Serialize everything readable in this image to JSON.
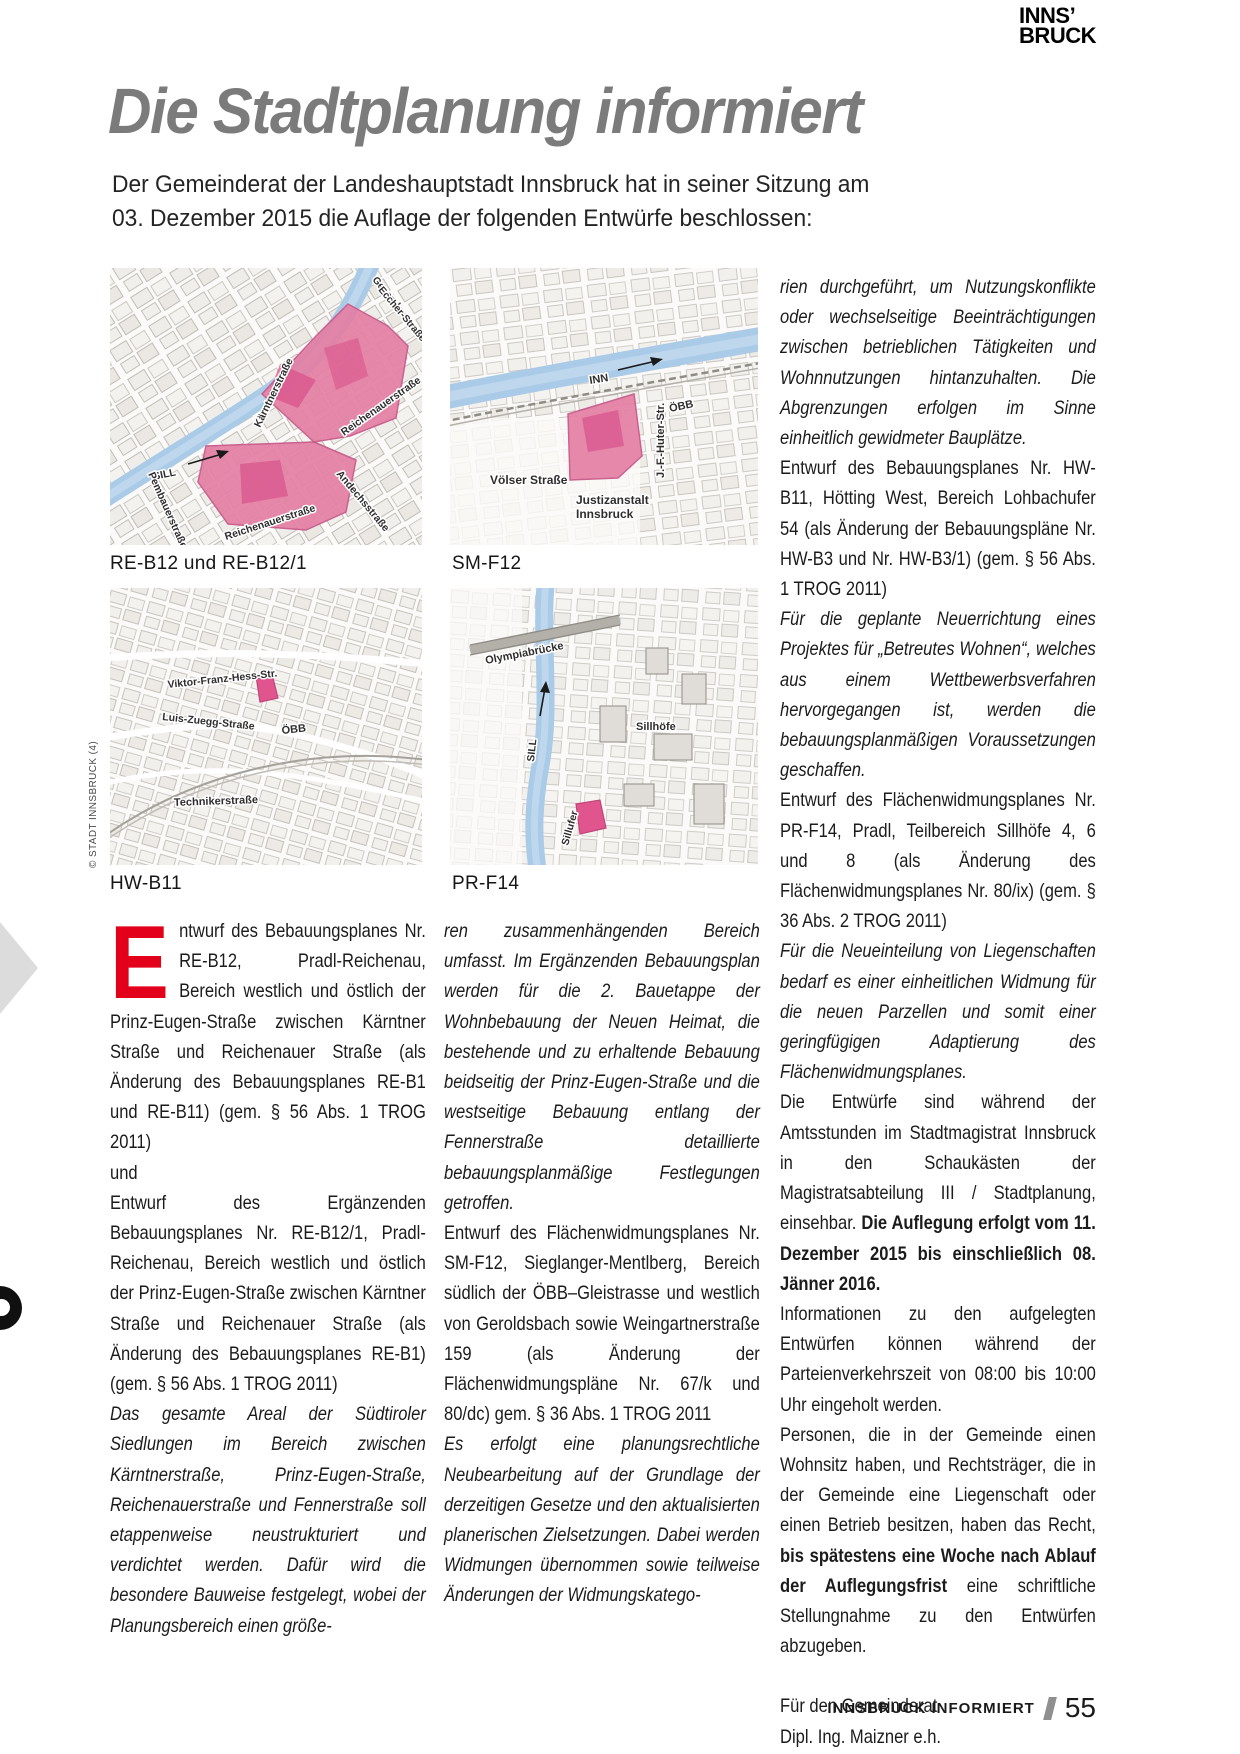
{
  "page": {
    "logo_line1": "INNS’",
    "logo_line2": "BRUCK",
    "title": "Die Stadtplanung informiert",
    "intro_line1": "Der Gemeinderat der Landeshauptstadt Innsbruck hat in seiner Sitzung am",
    "intro_line2": "03. Dezember 2015 die Auflage der folgenden Entwürfe beschlossen:",
    "credit": "© STADT INNSBRUCK (4)"
  },
  "colors": {
    "accent_red": "#e2001a",
    "highlight_pink": "#e47fa4",
    "river_blue": "#a9cbe7",
    "title_gray": "#7b7b7b",
    "footer_slash_gray": "#8f8f8f"
  },
  "maps": [
    {
      "id": "RE-B12",
      "caption": "RE-B12 und RE-B12/1",
      "labels": {
        "general_1": "General-",
        "general_2": "Eccher-Straße",
        "kaerntner": "Kärntnerstraße",
        "reichenauer_right": "Reichenauerstraße",
        "sill": "SILL",
        "pembauer": "Pembauerstraße",
        "reichenauer_bottom": "Reichenauerstraße",
        "andechs": "Andechsstraße"
      }
    },
    {
      "id": "SM-F12",
      "caption": "SM-F12",
      "labels": {
        "inn": "INN",
        "oebb": "ÖBB",
        "voelser": "Völser Straße",
        "huter": "J.-F.-Huter-Str.",
        "justiz_1": "Justizanstalt",
        "justiz_2": "Innsbruck"
      }
    },
    {
      "id": "HW-B11",
      "caption": "HW-B11",
      "labels": {
        "viktor": "Viktor-Franz-Hess-Str.",
        "luis": "Luis-Zuegg-Straße",
        "oebb": "ÖBB",
        "techniker": "Technikerstraße"
      }
    },
    {
      "id": "PR-F14",
      "caption": "PR-F14",
      "labels": {
        "olympiabruecke": "Olympiabrücke",
        "sill": "SILL",
        "sillhoefe": "Sillhöfe",
        "sillufer": "Sillufer"
      }
    }
  ],
  "columns": {
    "col1": {
      "paragraphs": [
        {
          "runs": [
            {
              "t": "E",
              "drop": true
            },
            {
              "t": "ntwurf des Bebauungsplanes Nr. RE-B12, Pradl-Reichenau, Bereich westlich und östlich der Prinz-Eugen-Straße zwischen Kärntner Straße und Reichenauer Straße (als Änderung des Bebauungsplanes RE-B1 und RE-B11) (gem. § 56 Abs. 1 TROG 2011)"
            }
          ]
        },
        {
          "runs": [
            {
              "t": "und"
            }
          ]
        },
        {
          "runs": [
            {
              "t": "Entwurf des Ergänzenden Bebauungsplanes Nr. RE-B12/1, Pradl-Reichenau, Bereich westlich und östlich der Prinz-Eugen-Straße zwischen Kärntner Straße und Reichenauer Straße (als Änderung des Bebauungsplanes RE-B1) (gem. § 56 Abs. 1 TROG 2011)"
            }
          ]
        },
        {
          "runs": [
            {
              "t": "Das gesamte Areal der Südtiroler Siedlungen im Bereich zwischen Kärntnerstraße, Prinz-Eugen-Straße, Reichenauerstraße und Fennerstraße soll etappenweise neustrukturiert und verdichtet werden. Dafür wird die besondere Bauweise festgelegt, wobei der Planungsbereich einen größe-",
              "i": true
            }
          ]
        }
      ]
    },
    "col2": {
      "paragraphs": [
        {
          "runs": [
            {
              "t": "ren zusammenhängenden Bereich umfasst. Im Ergänzenden Bebauungsplan werden für die 2. Bauetappe der Wohnbebauung der Neuen Heimat, die bestehende und zu erhaltende Bebauung beidseitig der Prinz-Eugen-Straße und die westseitige Bebauung entlang der Fennerstraße detaillierte bebauungsplanmäßige Festlegungen getroffen.",
              "i": true
            }
          ]
        },
        {
          "runs": [
            {
              "t": "Entwurf des Flächenwidmungsplanes Nr. SM-F12, Sieglanger-Mentlberg, Bereich südlich der ÖBB–Gleistrasse und westlich von Geroldsbach sowie Weingartnerstraße 159 (als Änderung der Flächenwidmungspläne Nr. 67/k und 80/dc) gem. § 36 Abs. 1 TROG 2011"
            }
          ]
        },
        {
          "runs": [
            {
              "t": "Es erfolgt eine planungsrechtliche Neubearbeitung auf der Grundlage der derzeitigen Gesetze und den aktualisierten planerischen Zielsetzungen. Dabei werden Widmungen übernommen sowie teilweise Änderungen der Widmungskatego-",
              "i": true
            }
          ]
        }
      ]
    },
    "col3": {
      "paragraphs": [
        {
          "runs": [
            {
              "t": "rien durchgeführt, um Nutzungskonflikte oder wechselseitige Beeinträchtigungen zwischen betrieblichen Tätigkeiten und Wohnnutzungen hintanzuhalten. Die Abgrenzungen erfolgen im Sinne einheitlich gewidmeter Bauplätze.",
              "i": true
            }
          ]
        },
        {
          "runs": [
            {
              "t": "Entwurf des Bebauungsplanes Nr. HW-B11, Hötting West, Bereich Lohbachufer 54 (als Änderung der Bebauungspläne Nr. HW-B3 und Nr. HW-B3/1) (gem. § 56 Abs. 1 TROG 2011)"
            }
          ]
        },
        {
          "runs": [
            {
              "t": "Für die geplante Neuerrichtung eines Projektes für „Betreutes Wohnen“, welches aus einem Wettbewerbsverfahren hervorgegangen ist, werden die bebauungsplanmäßigen Voraussetzungen geschaffen.",
              "i": true
            }
          ]
        },
        {
          "runs": [
            {
              "t": "Entwurf des Flächenwidmungsplanes Nr. PR-F14, Pradl, Teilbereich Sillhöfe 4, 6 und 8 (als Änderung des Flächenwidmungsplanes Nr. 80/ix) (gem. § 36 Abs. 2 TROG 2011)"
            }
          ]
        },
        {
          "runs": [
            {
              "t": "Für die Neueinteilung von Liegenschaften bedarf es einer einheitlichen Widmung für die neuen Parzellen und somit einer geringfügigen Adaptierung des Flächenwidmungsplanes.",
              "i": true
            }
          ]
        },
        {
          "runs": [
            {
              "t": "Die Entwürfe sind während der Amtsstunden im Stadtmagistrat Innsbruck in den Schaukästen der Magistratsabteilung III / Stadtplanung, einsehbar. "
            },
            {
              "t": "Die Auflegung erfolgt vom 11. Dezember 2015 bis einschließlich 08. Jänner 2016.",
              "b": true
            }
          ]
        },
        {
          "runs": [
            {
              "t": "Informationen zu den aufgelegten Entwürfen können während der Parteienverkehrszeit von 08:00 bis 10:00 Uhr eingeholt werden."
            }
          ]
        },
        {
          "runs": [
            {
              "t": "Personen, die in der Gemeinde einen Wohnsitz haben, und Rechtsträger, die in der Gemeinde eine Liegenschaft oder einen Betrieb besitzen, haben das Recht, "
            },
            {
              "t": "bis spätestens eine Woche nach Ablauf der Auflegungsfrist",
              "b": true
            },
            {
              "t": " eine schriftliche Stellungnahme zu den Entwürfen abzugeben."
            }
          ]
        }
      ]
    }
  },
  "signature": {
    "line1": "Für den Gemeinderat",
    "line2": "Dipl. Ing. Maizner e.h.",
    "line3": "(Baudirektor)"
  },
  "footer": {
    "magazine": "INNSBRUCK INFORMIERT",
    "page_number": "55"
  }
}
